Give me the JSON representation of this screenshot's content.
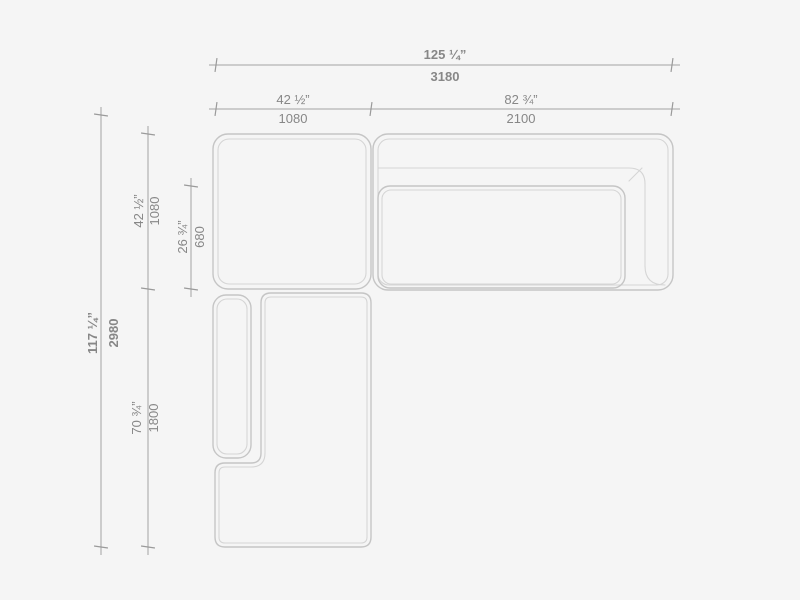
{
  "colors": {
    "background": "#f5f5f5",
    "dimension_line": "#a3a3a3",
    "sofa_outline": "#c5c5c5",
    "sofa_inner_line": "#d5d5d5",
    "label_text": "#878787"
  },
  "dimensions": {
    "overall_width": {
      "inches": "125 ¼”",
      "mm": "3180"
    },
    "corner_module_width": {
      "inches": "42 ½”",
      "mm": "1080"
    },
    "sofa_module_width": {
      "inches": "82 ¾”",
      "mm": "2100"
    },
    "overall_depth": {
      "inches": "117 ¼”",
      "mm": "2980"
    },
    "corner_module_depth": {
      "inches": "42 ½”",
      "mm": "1080"
    },
    "seat_depth": {
      "inches": "26 ¾”",
      "mm": "680"
    },
    "chaise_module_length": {
      "inches": "70 ¾”",
      "mm": "1800"
    }
  }
}
